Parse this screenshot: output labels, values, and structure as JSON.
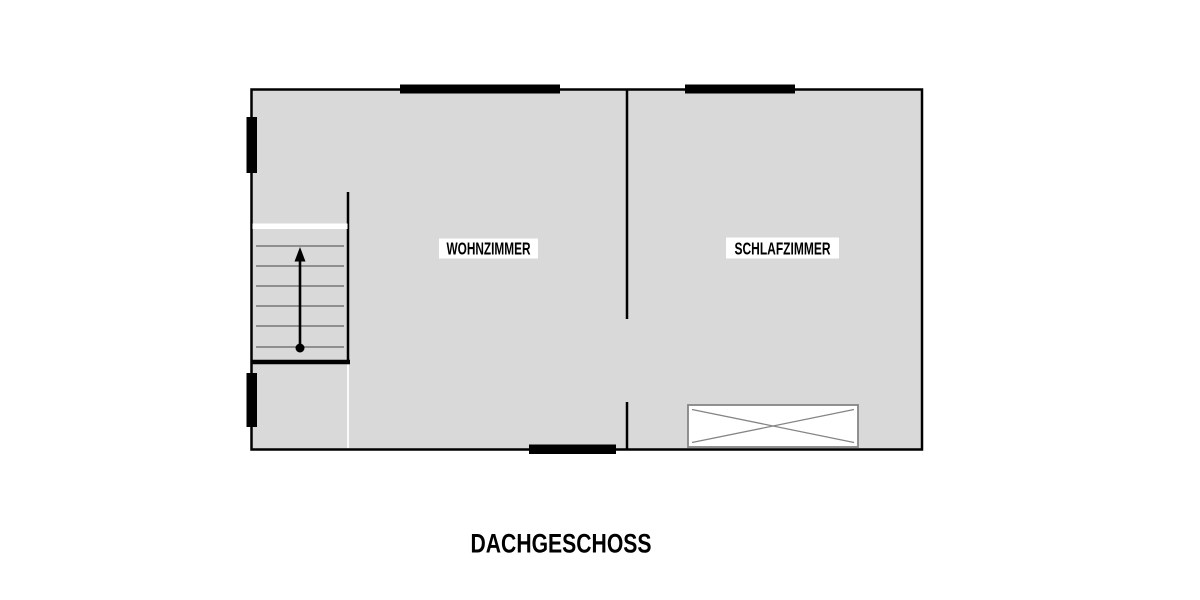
{
  "title": "DACHGESCHOSS",
  "rooms": [
    {
      "name": "WOHNZIMMER"
    },
    {
      "name": "SCHLAFZIMMER"
    }
  ],
  "staircase": {
    "treads": 6,
    "direction_arrow": "up"
  },
  "symbols": {
    "window_markers": 5,
    "door_openings": 1,
    "closet": "crossed-rectangle"
  },
  "colors": {
    "background": "#ffffff",
    "floor_fill": "#d9d9d9",
    "wall": "#000000",
    "stair_tread": "#8f8f8f",
    "furniture_line": "#858585",
    "label_background": "#ffffff",
    "text": "#000000"
  }
}
